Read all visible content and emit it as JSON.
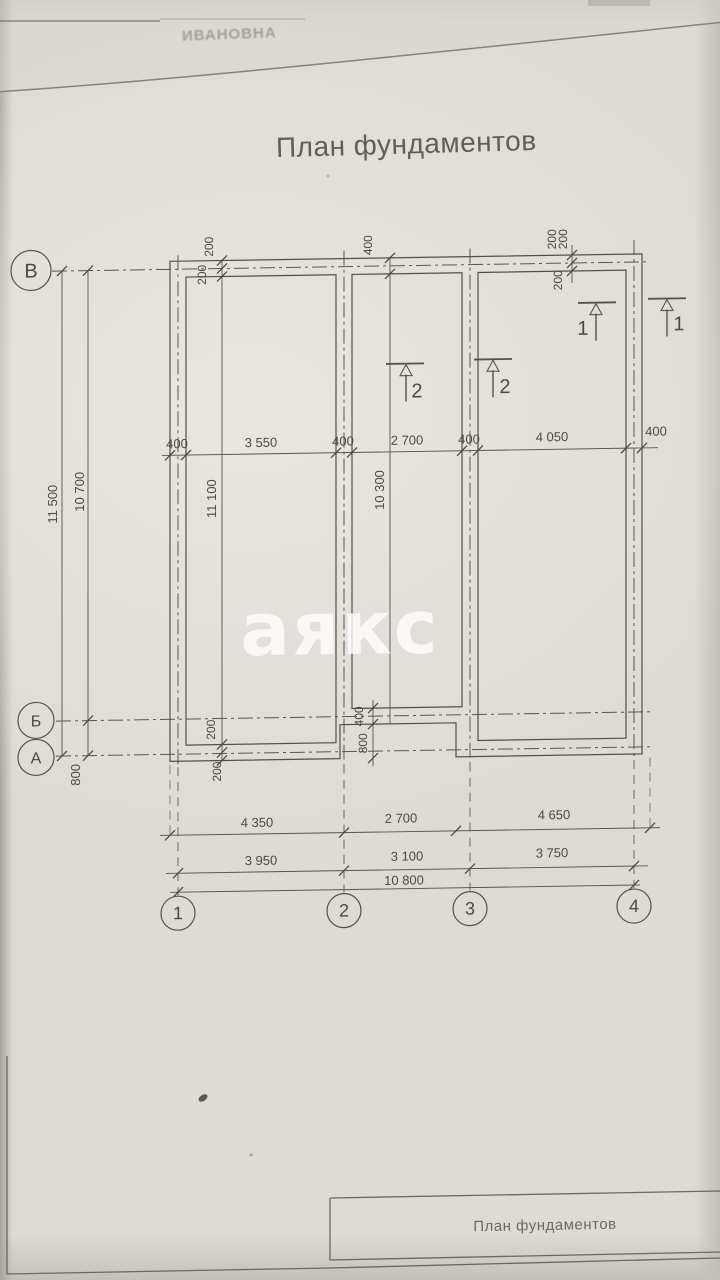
{
  "header": {
    "title": "План фундаментов",
    "fragment": "ИВАНОВНА",
    "watermark": "аякс"
  },
  "titleblock": {
    "label": "План фундаментов"
  },
  "axes": {
    "rows": [
      "В",
      "Б",
      "А"
    ],
    "cols": [
      "1",
      "2",
      "3",
      "4"
    ]
  },
  "sections": {
    "s1": "1",
    "s2": "2"
  },
  "dims": {
    "left_total": "11 500",
    "left_vb": "10 700",
    "left_ab": "800",
    "mid": [
      "400",
      "3 550",
      "400",
      "2 700",
      "400",
      "4 050",
      "400"
    ],
    "inner_left": "11 100",
    "inner_mid": "10 300",
    "top_offsets": [
      "200",
      "200",
      "400",
      "200",
      "200",
      "200"
    ],
    "bottom_offsets": [
      "200",
      "200",
      "400",
      "800"
    ],
    "row1": [
      "4 350",
      "2 700",
      "4 650"
    ],
    "row2": [
      "3 950",
      "3 100",
      "3 750"
    ],
    "total": "10 800"
  },
  "colors": {
    "paper": "#dedad5",
    "line": "#55514b",
    "text": "#4c4943",
    "watermark_white": "#ffffff"
  }
}
